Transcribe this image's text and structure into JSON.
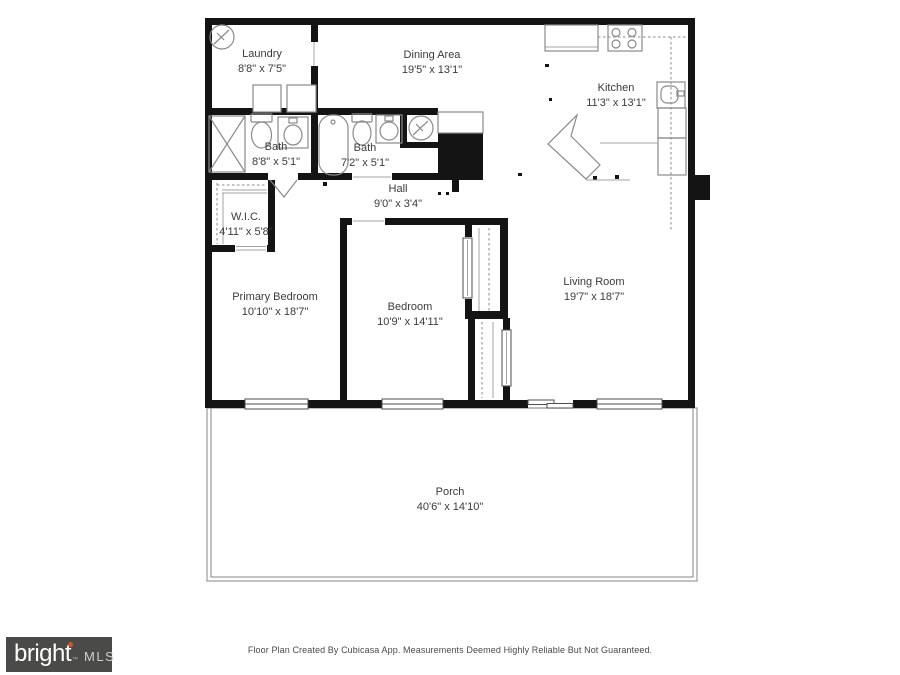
{
  "rooms": [
    {
      "id": "laundry",
      "name": "Laundry",
      "dims": "8'8\" x 7'5\""
    },
    {
      "id": "dining",
      "name": "Dining Area",
      "dims": "19'5\" x 13'1\""
    },
    {
      "id": "kitchen",
      "name": "Kitchen",
      "dims": "11'3\" x 13'1\""
    },
    {
      "id": "bath1",
      "name": "Bath",
      "dims": "8'8\" x 5'1\""
    },
    {
      "id": "bath2",
      "name": "Bath",
      "dims": "7'2\" x 5'1\""
    },
    {
      "id": "hall",
      "name": "Hall",
      "dims": "9'0\" x 3'4\""
    },
    {
      "id": "wic",
      "name": "W.I.C.",
      "dims": "4'11\" x 5'8\""
    },
    {
      "id": "primary_bedroom",
      "name": "Primary Bedroom",
      "dims": "10'10\" x 18'7\""
    },
    {
      "id": "bedroom",
      "name": "Bedroom",
      "dims": "10'9\" x 14'11\""
    },
    {
      "id": "living_room",
      "name": "Living Room",
      "dims": "19'7\" x 18'7\""
    },
    {
      "id": "porch",
      "name": "Porch",
      "dims": "40'6\" x 14'10\""
    }
  ],
  "footer": {
    "credit": "Floor Plan Created By Cubicasa App. Measurements Deemed Highly Reliable But Not Guaranteed."
  },
  "logo": {
    "brand": "bright",
    "tm": "™",
    "suffix": "MLS"
  },
  "icons": [
    {
      "name": "hvac-unit-icon",
      "shape": "circle-with-zigzag"
    },
    {
      "name": "water-heater-icon",
      "shape": "circle-with-zigzag"
    },
    {
      "name": "washer-icon",
      "shape": "square"
    },
    {
      "name": "dryer-icon",
      "shape": "square"
    },
    {
      "name": "shower-icon",
      "shape": "rect-with-x"
    },
    {
      "name": "toilet-icon",
      "shape": "tank-and-bowl"
    },
    {
      "name": "vanity-sink-icon",
      "shape": "rect-with-basin"
    },
    {
      "name": "bathtub-icon",
      "shape": "rounded-tub"
    },
    {
      "name": "stove-icon",
      "shape": "four-burner-cooktop"
    },
    {
      "name": "kitchen-sink-icon",
      "shape": "rounded-basin-with-faucet"
    },
    {
      "name": "fireplace-chimney-icon",
      "shape": "filled-black-rect"
    },
    {
      "name": "window-icon",
      "shape": "double-line-rect"
    },
    {
      "name": "sliding-door-icon",
      "shape": "offset-double-rect"
    },
    {
      "name": "door-swing-icon",
      "shape": "open-v"
    },
    {
      "name": "closet-rod-icon",
      "shape": "dashed-line"
    },
    {
      "name": "logo-flame-icon",
      "shape": "orange-dot"
    }
  ],
  "colors": {
    "wall": "#141414",
    "fixture_outline": "#8a8a8a",
    "label_text": "#3b3b3b",
    "footer_text": "#4a4a4a",
    "logo_bg": "#4a4a48",
    "logo_text": "#ffffff",
    "logo_mls": "#cfcfcd",
    "logo_accent": "#d4552e"
  }
}
